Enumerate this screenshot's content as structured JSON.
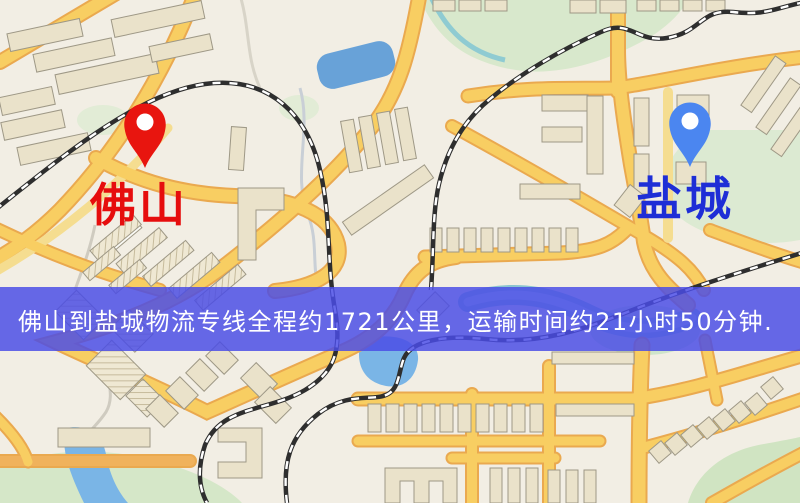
{
  "map": {
    "origin": {
      "label": "佛山",
      "text_color": "#e60d0d",
      "pin_color": "#e8150f"
    },
    "destination": {
      "label": "盐城",
      "text_color": "#1e2ed6",
      "pin_color": "#4b86f0"
    },
    "banner": {
      "text": "佛山到盐城物流专线全程约1721公里，运输时间约21小时50分钟.",
      "background": "#4a4ce6",
      "text_color": "#ffffff",
      "distance_km": "1721",
      "duration_hours": "21",
      "duration_minutes": "50"
    },
    "palette": {
      "map_background": "#f2eee4",
      "road_fill": "#f8ce62",
      "road_casing": "#eaa94f",
      "minor_road": "#f5dd90",
      "building_fill": "#eae2ca",
      "park_green": "#d8e8cc",
      "water_blue": "#68a2d8",
      "river_teal": "#8ac4cf",
      "railway_dark": "#2e2e2e"
    }
  }
}
